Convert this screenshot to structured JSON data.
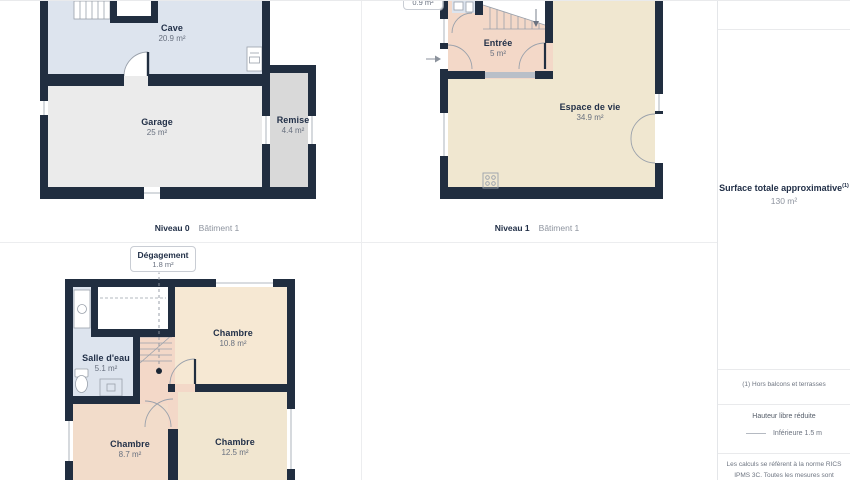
{
  "plans": [
    {
      "level_label": "Niveau 0",
      "building_label": "Bâtiment 1",
      "rooms": [
        {
          "name": "Cave",
          "area": "20.9 m²"
        },
        {
          "name": "Garage",
          "area": "25 m²"
        },
        {
          "name": "Remise",
          "area": "4.4 m²"
        }
      ]
    },
    {
      "level_label": "Niveau 1",
      "building_label": "Bâtiment 1",
      "callout_area": "0.9 m²",
      "rooms": [
        {
          "name": "Entrée",
          "area": "5 m²"
        },
        {
          "name": "Espace de vie",
          "area": "34.9 m²"
        }
      ]
    },
    {
      "callout_name": "Dégagement",
      "callout_area": "1.8 m²",
      "rooms": [
        {
          "name": "Salle d'eau",
          "area": "5.1 m²"
        },
        {
          "name": "Chambre",
          "area": "10.8 m²"
        },
        {
          "name": "Chambre",
          "area": "8.7 m²"
        },
        {
          "name": "Chambre",
          "area": "12.5 m²"
        }
      ]
    }
  ],
  "sidebar": {
    "total_title": "Surface totale approximative",
    "total_sup": "(1)",
    "total_value": "130 m²",
    "footnote": "(1) Hors balcons et terrasses",
    "legend_title": "Hauteur libre réduite",
    "legend_item": "Inférieure 1.5 m",
    "disclaimer_line1": "Les calculs se réfèrent à la norme RICS",
    "disclaimer_line2": "IPMS 3C. Toutes les mesures sont"
  },
  "colors": {
    "wall": "#212e40",
    "blue_room": "#dde4ee",
    "beige_room": "#f0e7d0",
    "salmon_room": "#f3d8c8",
    "gray_room": "#ebebeb"
  }
}
